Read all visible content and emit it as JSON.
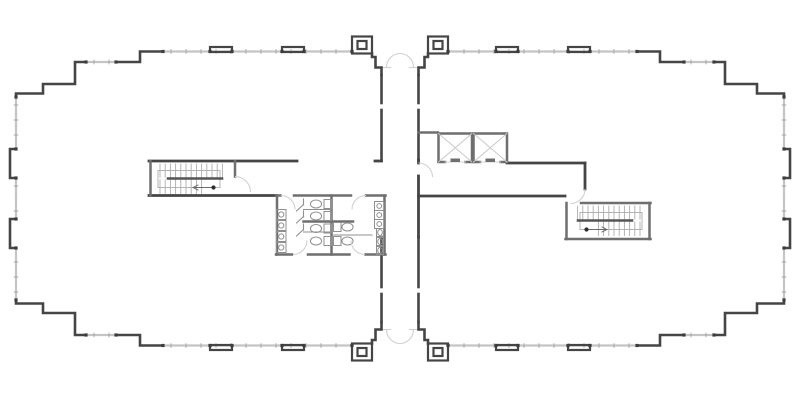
{
  "canvas": {
    "width": 800,
    "height": 400,
    "background": "#ffffff"
  },
  "palette": {
    "wall_dark": "#454545",
    "wall_core": "#6f6f6f",
    "wall_thin": "#8f8f8f",
    "window": "#c4c4c4",
    "tick": "#9c9c9c",
    "node": "#3d3d3d",
    "door_arc": "#d0d0d0",
    "fixture": "#8f8f8f",
    "tread": "#adadad",
    "shaft_x": "#c9c9c9",
    "rail": "#555555",
    "slab": "#6f6f6f"
  },
  "mirror": {
    "cx": 400,
    "cy": 198.5,
    "stair_right_transform": "translate(800,42) scale(-1,1)"
  },
  "shell": {
    "dark_polylines": [
      [
        [
          16,
          97
        ],
        [
          16,
          93.5
        ],
        [
          43,
          93.5
        ],
        [
          43,
          84
        ],
        [
          75,
          84
        ],
        [
          75,
          62
        ],
        [
          86,
          62
        ]
      ],
      [
        [
          116,
          62
        ],
        [
          140,
          62
        ],
        [
          140,
          51.5
        ],
        [
          163,
          51.5
        ]
      ],
      [
        [
          16,
          149
        ],
        [
          10,
          149
        ],
        [
          10,
          178
        ],
        [
          16,
          178
        ]
      ],
      [
        [
          372,
          53.5
        ],
        [
          372,
          57
        ],
        [
          375.5,
          57
        ],
        [
          375.5,
          67.5
        ],
        [
          381.5,
          67.5
        ],
        [
          381.5,
          75
        ]
      ],
      [
        [
          381.5,
          75
        ],
        [
          381.5,
          103
        ]
      ],
      [
        [
          381.5,
          110
        ],
        [
          381.5,
          160
        ]
      ]
    ],
    "dark_rects": [
      [
        210,
        47,
        22,
        5
      ],
      [
        282,
        47,
        22,
        5
      ],
      [
        352,
        36.5,
        20,
        17
      ],
      [
        357.5,
        41,
        9,
        8
      ]
    ],
    "windows": [
      [
        16,
        97,
        16,
        149
      ],
      [
        16,
        178,
        16,
        198.5
      ],
      [
        86,
        62,
        116,
        62
      ],
      [
        163,
        51.5,
        352,
        51.5
      ]
    ],
    "tick_step": 15,
    "nodes": [
      [
        16,
        97
      ],
      [
        16,
        149
      ],
      [
        16,
        178
      ],
      [
        86,
        62
      ],
      [
        116,
        62
      ],
      [
        163,
        51.5
      ],
      [
        210,
        51.5
      ],
      [
        232,
        51.5
      ],
      [
        282,
        51.5
      ],
      [
        304,
        51.5
      ],
      [
        352,
        51.5
      ]
    ],
    "light_segs": [
      [
        381.5,
        67.5,
        390.5,
        67.5
      ]
    ],
    "arc_paths": [
      "M 386.5 67.5 A 13.5 14 0 0 1 400 53.5"
    ]
  },
  "interior": {
    "dark_segs": [
      [
        149,
        161,
        297,
        161
      ],
      [
        375,
        161,
        381.5,
        161
      ],
      [
        149,
        195.5,
        276,
        195.5
      ],
      [
        418.5,
        196,
        565,
        196
      ],
      [
        507,
        163,
        585,
        163
      ],
      [
        585,
        163,
        585,
        189
      ],
      [
        418.5,
        160,
        418.5,
        163
      ],
      [
        418.5,
        176,
        418.5,
        237
      ]
    ],
    "core_segs": [
      [
        150.5,
        161,
        150.5,
        195.5
      ],
      [
        235,
        161,
        235,
        176.5
      ],
      [
        581,
        203,
        650.5,
        203
      ],
      [
        566.5,
        203,
        566.5,
        239
      ],
      [
        565.5,
        239,
        650.5,
        239
      ],
      [
        649.5,
        203,
        649.5,
        239
      ],
      [
        276,
        195.5,
        280.5,
        195.5
      ],
      [
        294,
        195.5,
        351,
        195.5
      ],
      [
        366,
        195.5,
        385.5,
        195.5
      ],
      [
        276,
        254.5,
        292,
        254.5
      ],
      [
        308,
        254.5,
        349.5,
        254.5
      ],
      [
        365.5,
        254.5,
        385.5,
        254.5
      ],
      [
        277,
        195.5,
        277,
        254.5
      ],
      [
        384.5,
        195.5,
        384.5,
        254.5
      ],
      [
        331.5,
        195.5,
        331.5,
        254.5
      ],
      [
        303.5,
        221.5,
        353,
        221.5
      ],
      [
        418.5,
        132.5,
        438,
        132.5
      ]
    ],
    "thin_segs": [
      [
        303.5,
        209.5,
        331.5,
        209.5
      ],
      [
        303.5,
        232,
        331.5,
        232
      ],
      [
        333.5,
        235,
        372,
        235
      ],
      [
        303.5,
        199,
        303.5,
        205
      ],
      [
        303.5,
        211,
        303.5,
        217
      ],
      [
        303.5,
        224,
        303.5,
        230
      ],
      [
        303.5,
        204.5,
        296.5,
        211
      ],
      [
        303.5,
        216.5,
        296.5,
        223
      ],
      [
        303.5,
        229.5,
        296.5,
        236
      ]
    ],
    "arc_paths": [
      "M 235 176.5 A 15.5 15.5 0 0 1 250.5 192",
      "M 585 189 A 14.5 14.5 0 0 1 570.5 203.5",
      "M 418.5 163 A 14 14 0 0 1 432.5 177",
      "M 281 195.5 A 14 14 0 0 1 295 209.5",
      "M 366 195.5 A 14 14 0 0 0 352 209.5",
      "M 293 254.5 A 14 14 0 0 0 307 240.5",
      "M 365 254.5 A 14 14 0 0 1 351 240.5"
    ]
  },
  "elevators": {
    "y": 133.5,
    "h": 28.5,
    "shafts": [
      {
        "x": 438.5,
        "w": 33.5
      },
      {
        "x": 473.5,
        "w": 33.5
      }
    ],
    "door_gap": 20.5,
    "slab": {
      "w": 9.5,
      "h": 3.5
    }
  },
  "stair": {
    "treads_upper": {
      "x0": 160,
      "n": 13,
      "dx": 5.2,
      "y1": 164,
      "y2": 177
    },
    "treads_lower": {
      "x0": 160,
      "n": 9,
      "dx": 5.2,
      "y1": 180,
      "y2": 193.5
    },
    "rail_bar": [
      168,
      178.5,
      222,
      178.5
    ],
    "rail_box": [
      158,
      170.5,
      62,
      17
    ],
    "dot": {
      "x": 213.5,
      "y": 187.5,
      "r": 2.1
    },
    "arrow_line": [
      193,
      187.5,
      211,
      187.5
    ],
    "arrow_head": [
      [
        193,
        187.5,
        198,
        185
      ],
      [
        193,
        187.5,
        198,
        190
      ]
    ]
  },
  "restroom": {
    "sinks_left": {
      "x": 276.5,
      "w": 9.5,
      "h": 10,
      "ys": [
        209.5,
        220.5,
        231.5,
        242.5
      ],
      "cr": 2.6
    },
    "sinks_right": {
      "x": 374.5,
      "w": 9.5,
      "h": 9,
      "ys": [
        201.5,
        210.5,
        219.5
      ],
      "cr": 2.4
    },
    "toilets_left": {
      "tank_x": 324,
      "tank_w": 7.5,
      "tank_h": 9,
      "bowl_cx": 316,
      "rx": 5.6,
      "ry": 4,
      "ycs": [
        204,
        216,
        228.5,
        241
      ]
    },
    "toilets_right": {
      "tank_x": 333.5,
      "tank_w": 7.5,
      "tank_h": 9,
      "bowl_cx": 347.5,
      "rx": 5.6,
      "ry": 4,
      "ycs": [
        227,
        241
      ]
    },
    "urinals": {
      "x": 376.5,
      "w": 7,
      "h": 8,
      "ys": [
        228.5,
        237.5,
        246.5
      ],
      "rx": 2.3,
      "ry": 3
    }
  }
}
